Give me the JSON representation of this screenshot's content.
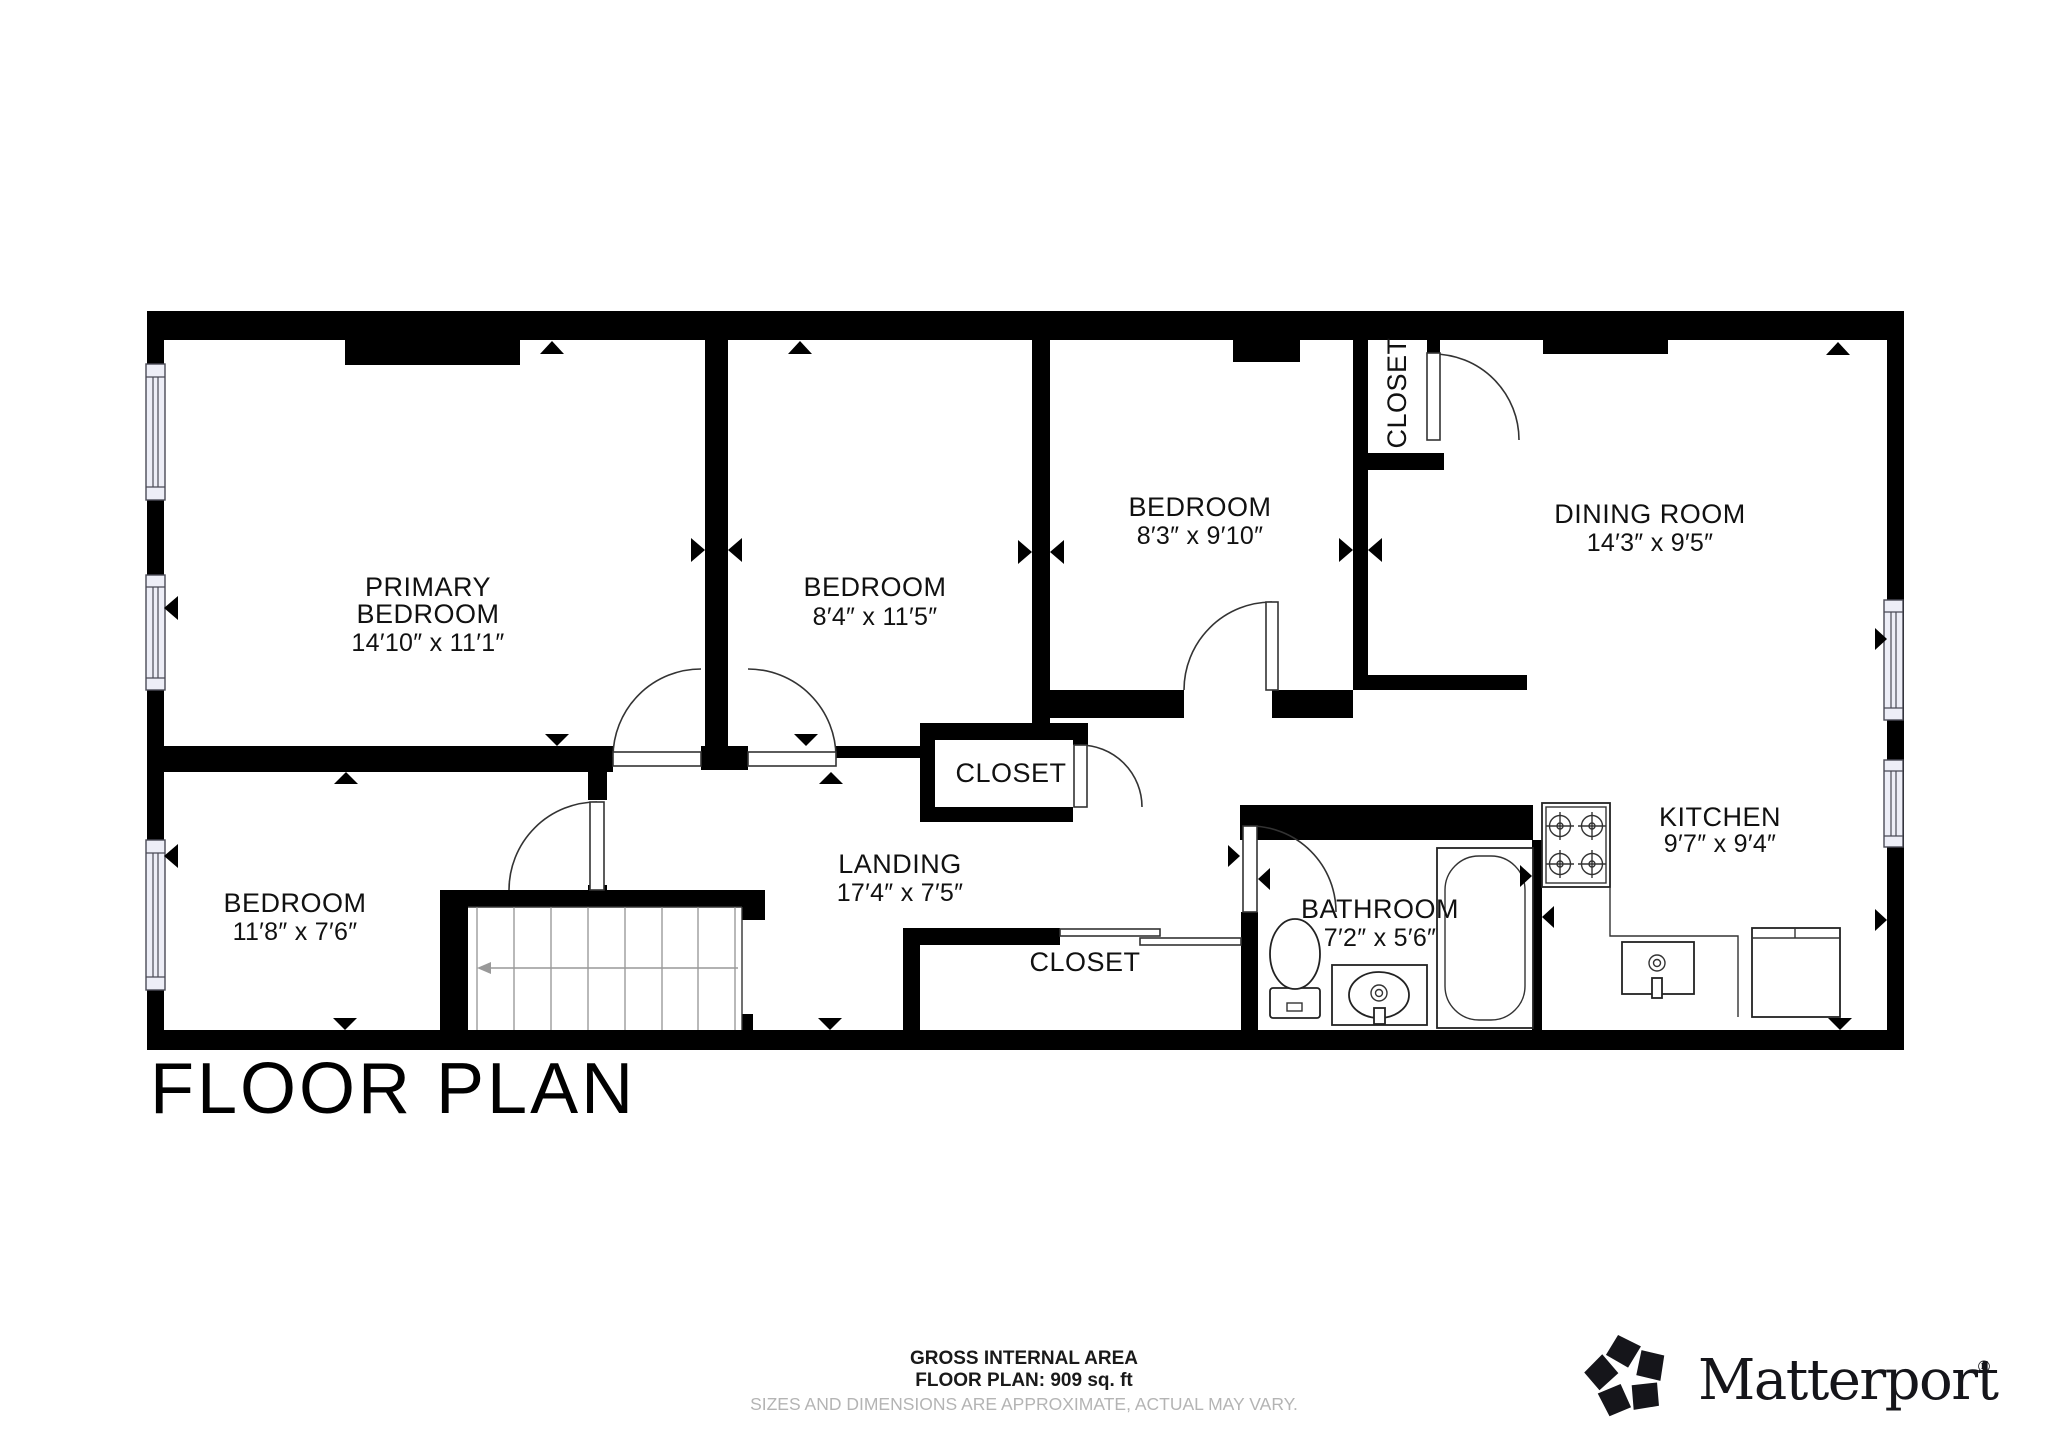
{
  "title": "FLOOR PLAN",
  "rooms": {
    "primary_bedroom": {
      "label_line1": "PRIMARY",
      "label_line2": "BEDROOM",
      "dims": "14′10″ x 11′1″"
    },
    "bedroom_2": {
      "label": "BEDROOM",
      "dims": "8′4″ x 11′5″"
    },
    "bedroom_3": {
      "label": "BEDROOM",
      "dims": "8′3″ x 9′10″"
    },
    "dining_room": {
      "label": "DINING ROOM",
      "dims": "14′3″ x 9′5″"
    },
    "closet_top": {
      "label": "CLOSET"
    },
    "bedroom_4": {
      "label": "BEDROOM",
      "dims": "11′8″ x 7′6″"
    },
    "landing": {
      "label": "LANDING",
      "dims": "17′4″ x 7′5″"
    },
    "closet_middle": {
      "label": "CLOSET"
    },
    "closet_bottom": {
      "label": "CLOSET"
    },
    "bathroom": {
      "label": "BATHROOM",
      "dims": "7′2″ x 5′6″"
    },
    "kitchen": {
      "label": "KITCHEN",
      "dims": "9′7″ x 9′4″"
    }
  },
  "footer": {
    "line1": "GROSS INTERNAL AREA",
    "line2": "FLOOR PLAN: 909 sq. ft",
    "disclaimer": "SIZES AND DIMENSIONS ARE APPROXIMATE, ACTUAL MAY VARY."
  },
  "brand": {
    "name": "Matterport",
    "registered_mark": "®"
  },
  "fixtures": [
    "staircase",
    "toilet",
    "bathroom-sink",
    "bathtub",
    "stove",
    "kitchen-sink",
    "refrigerator"
  ],
  "colors": {
    "wall": "#000000",
    "background": "#ffffff",
    "window_fill": "#edeef7",
    "stair_arrow": "#999999",
    "disclaimer_text": "#b4b4b4",
    "label_text": "#111111"
  }
}
